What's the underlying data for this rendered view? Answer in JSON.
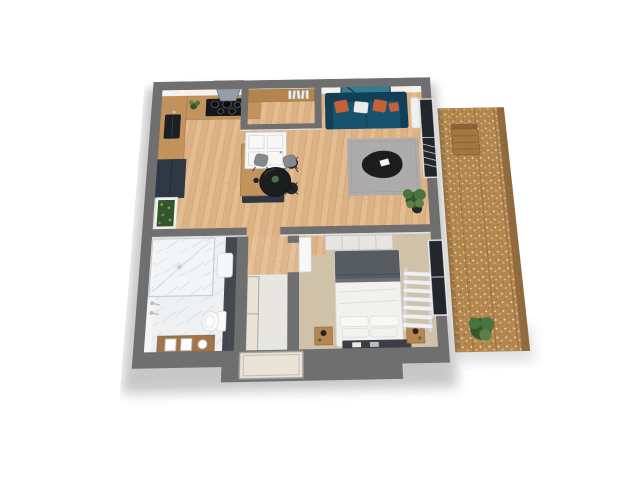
{
  "scene": {
    "type": "3d-floor-plan",
    "description": "3D top-down render of a one-bedroom apartment floor plan with balcony",
    "rooms": [
      {
        "name": "living-room",
        "furniture": [
          "teal-sofa",
          "orange-pillows",
          "white-pillow",
          "wall-art",
          "arc-floor-lamp",
          "gray-rug",
          "black-coffee-table",
          "round-dining-table",
          "two-chairs",
          "potted-plant",
          "window-with-blinds"
        ]
      },
      {
        "name": "kitchen",
        "furniture": [
          "l-shaped-wood-counter",
          "cooktop",
          "range-hood",
          "sink",
          "tall-dark-cabinet",
          "island-with-bowls",
          "bar-stools",
          "vertical-garden-panel",
          "counter-plant"
        ]
      },
      {
        "name": "entry-nook",
        "furniture": [
          "wood-shelf-with-books",
          "white-double-door"
        ]
      },
      {
        "name": "bedroom",
        "furniture": [
          "double-bed",
          "gray-blanket",
          "pillows",
          "bench",
          "two-nightstands",
          "lamps",
          "wardrobe",
          "towel-radiator",
          "window",
          "white-door"
        ]
      },
      {
        "name": "bathroom",
        "furniture": [
          "walk-in-shower",
          "chrome-fixtures",
          "toilet",
          "wall-basin",
          "wood-vanity",
          "mirrors",
          "dark-accent-wall"
        ]
      },
      {
        "name": "hallway",
        "furniture": [
          "cream-closet-panels",
          "built-in-closet"
        ]
      },
      {
        "name": "balcony",
        "furniture": [
          "wood-decking",
          "wooden-chair",
          "green-shrub"
        ]
      }
    ],
    "palette": {
      "wall": "#6f6f6f",
      "innerface": "#f7f7f7",
      "wood1": "#dcb183",
      "wood2": "#e8c69c",
      "wood3": "#c29563",
      "carpet": "#cfc2a9",
      "marble": "#eef0f2",
      "marblevein": "#d3d9dd",
      "accentwall": "#45494f",
      "cab": "#2e3742",
      "counter": "#c2935c",
      "hood": "#979da4",
      "hooddark": "#41464c",
      "sofa": "#17536e",
      "sofadark": "#113f55",
      "pilloworange": "#c6603a",
      "pillowwhite": "#edebe7",
      "artframe": "#4b4e52",
      "artlight": "#cfdfe4",
      "artorange": "#c95f33",
      "artteal": "#2e7f96",
      "rug": "#ababad",
      "blacktable": "#1c1d1f",
      "chair": "#85898d",
      "plant": "#4a7340",
      "plantdark": "#33562b",
      "plantlight": "#5d8049",
      "bedwhite": "#f1f1ef",
      "bedgray": "#575c61",
      "nstand": "#b9854f",
      "bench": "#3b3e42",
      "door": "#f7f7f7",
      "cream": "#eae4d6",
      "glass": "#23272d",
      "vanity": "#a1744a",
      "shelf": "#b3854e",
      "balwood": "#b5884f",
      "baledge": "#8a6439",
      "shadow": "#8f8f8f"
    }
  }
}
